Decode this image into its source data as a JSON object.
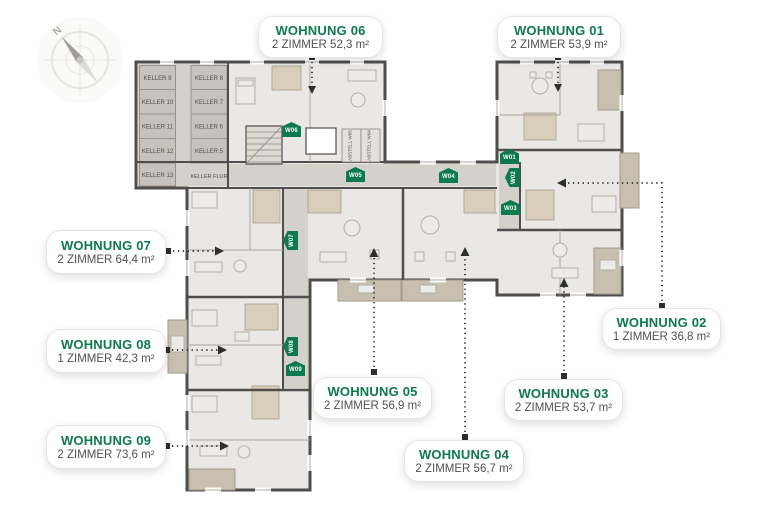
{
  "compass": {
    "north_label": "N"
  },
  "colors": {
    "brand_green": "#0d7a4e",
    "wall": "#4f4e4c",
    "floor": "#eae8e5",
    "corridor": "#d4d1cb",
    "keller_cell": "#c7c3bc",
    "balcony_tan": "#c9bfb0",
    "arrow": "#2e2e2e"
  },
  "apartments": [
    {
      "badge": "W01",
      "title": "WOHNUNG 01",
      "subtitle": "2 ZIMMER 53,9 m²"
    },
    {
      "badge": "W02",
      "title": "WOHNUNG 02",
      "subtitle": "1 ZIMMER 36,8 m²"
    },
    {
      "badge": "W03",
      "title": "WOHNUNG 03",
      "subtitle": "2 ZIMMER 53,7 m²"
    },
    {
      "badge": "W04",
      "title": "WOHNUNG 04",
      "subtitle": "2 ZIMMER 56,7 m²"
    },
    {
      "badge": "W05",
      "title": "WOHNUNG 05",
      "subtitle": "2 ZIMMER 56,9 m²"
    },
    {
      "badge": "W06",
      "title": "WOHNUNG 06",
      "subtitle": "2 ZIMMER 52,3 m²"
    },
    {
      "badge": "W07",
      "title": "WOHNUNG 07",
      "subtitle": "2 ZIMMER 64,4 m²"
    },
    {
      "badge": "W08",
      "title": "WOHNUNG 08",
      "subtitle": "1 ZIMMER 42,3 m²"
    },
    {
      "badge": "W09",
      "title": "WOHNUNG 09",
      "subtitle": "2 ZIMMER 73,6 m²"
    }
  ],
  "keller": {
    "cells": [
      "KELLER 9",
      "KELLER 10",
      "KELLER 11",
      "KELLER 12",
      "KELLER 13",
      "KELLER 8",
      "KELLER 7",
      "KELLER 6",
      "KELLER 5"
    ],
    "flur": "KELLER FLUR"
  },
  "storage": {
    "labels": [
      "ABSTELL W05",
      "ABSTELL W04"
    ]
  }
}
